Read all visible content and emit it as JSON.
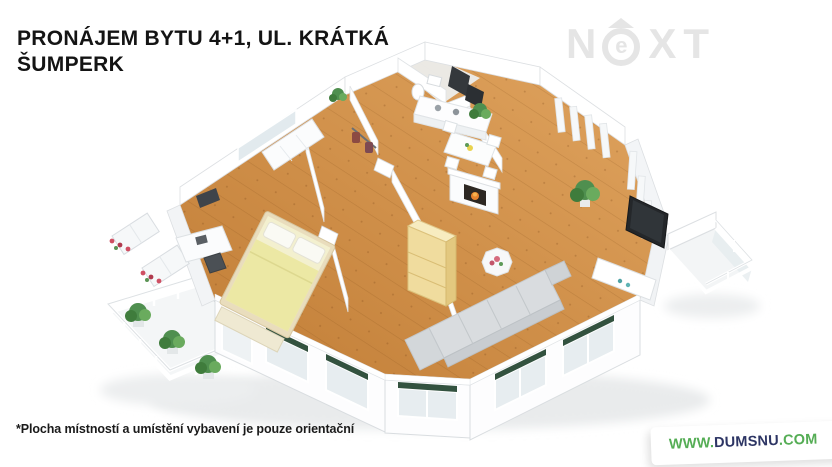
{
  "page": {
    "background": "#ffffff"
  },
  "header": {
    "title_line1": "PRONÁJEM BYTU 4+1, UL. KRÁTKÁ",
    "title_line2": "ŠUMPERK",
    "title_color": "#141414"
  },
  "watermark": {
    "letter_n": "N",
    "letter_e": "e",
    "letters_xt": "XT",
    "color": "#e5e5e5"
  },
  "floorplan": {
    "description": "3D cutaway floor plan of a 4+1 apartment with wooden floors, white walls, bedroom, study, kitchen with dining table, living room with sofa, TV and fireplace, and two balconies with plants",
    "colors": {
      "floor_wood": "#d0884a",
      "walls": "#ffffff",
      "wall_shade": "#f1f4f6",
      "window_box_green": "#33523f",
      "plant_green": "#4f8f4f",
      "bed_yellow": "#ece8a4",
      "wardrobe_yellow": "#f0dc9e",
      "sofa_gray": "#d6dadd",
      "tv_dark": "#24272a"
    }
  },
  "footer": {
    "disclaimer": "*Plocha místností a umístění vybavení je pouze orientační",
    "site": {
      "www": "WWW.",
      "name": "DUMSNU",
      "tld": ".COM",
      "green": "#55ad55",
      "navy": "#2d3564"
    }
  }
}
